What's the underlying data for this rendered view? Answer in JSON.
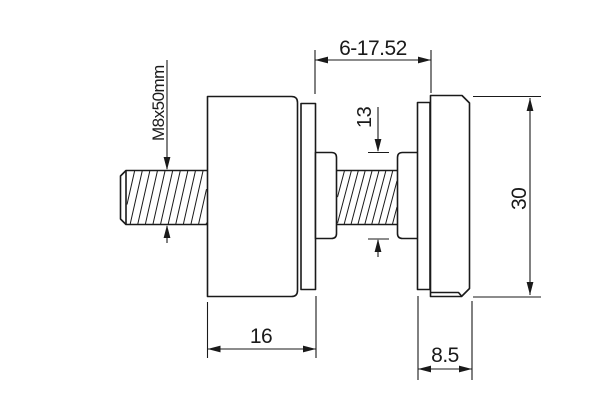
{
  "drawing": {
    "labels": {
      "thread_spec": "M8x50mm",
      "gap_range": "6-17.52",
      "stud_diameter": "13",
      "body_width": "16",
      "cap_width": "8.5",
      "outer_diameter": "30"
    },
    "colors": {
      "line": "#1a1a1a",
      "background": "#ffffff"
    }
  }
}
